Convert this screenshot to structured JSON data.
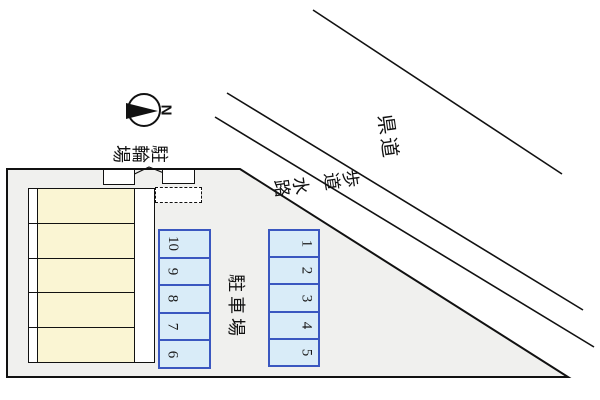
{
  "compass": {
    "north_label": "N"
  },
  "labels": {
    "prefectural_road": "県道",
    "sidewalk": "歩道",
    "waterway": "水路",
    "parking_lot": "駐車場",
    "bicycle_parking": "駐輪場"
  },
  "parking": {
    "left_column_stalls": [
      "10",
      "9",
      "8",
      "7",
      "6"
    ],
    "right_column_stalls": [
      "1",
      "2",
      "3",
      "4",
      "5"
    ]
  },
  "building": {
    "unit_count": 5
  },
  "colors": {
    "site_fill": "#f0f0ee",
    "building_fill": "#faf5d3",
    "stall_fill": "#d9ecf8",
    "stall_border": "#3a57c0",
    "drawing_line": "#111111"
  }
}
